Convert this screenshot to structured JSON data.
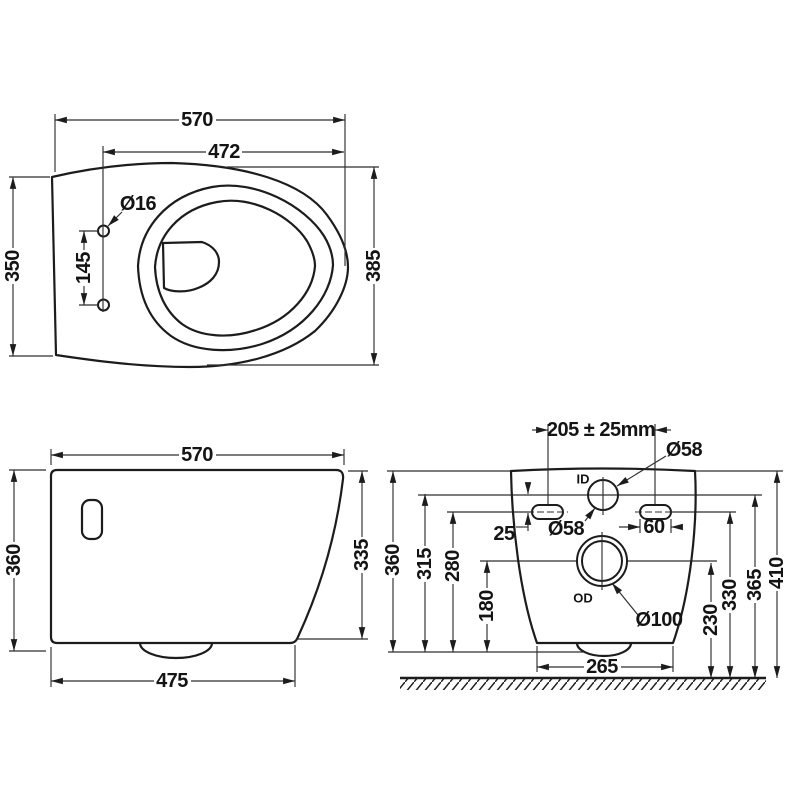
{
  "drawing": {
    "title": "wall-hung-toilet-dimension-drawing",
    "background": "#ffffff",
    "line_color": "#1c1c1c",
    "views": {
      "top_view": {
        "dim_overall_width": "570",
        "dim_hinge_to_front": "472",
        "dim_rear_depth": "350",
        "dim_bowl_depth": "385",
        "dim_hole_spacing": "145",
        "label_hole_diameter": "Ø16"
      },
      "side_view": {
        "dim_overall_length": "570",
        "dim_overall_height": "360",
        "dim_front_height": "335",
        "dim_bottom_length": "475"
      },
      "rear_view": {
        "dim_fixing_centres": "205  ± 25mm",
        "label_inlet_port": "ID",
        "label_inlet_diameter": "Ø58",
        "label_inlet_diameter_2": "Ø58",
        "dim_slot_offset": "25",
        "dim_slot_width": "60",
        "label_outlet_port": "OD",
        "label_outlet_diameter": "Ø100",
        "dim_base_width": "265",
        "dim_height_360": "360",
        "dim_height_315": "315",
        "dim_height_280": "280",
        "dim_height_180": "180",
        "dim_height_230": "230",
        "dim_height_330": "330",
        "dim_height_365": "365",
        "dim_height_410": "410"
      }
    }
  }
}
